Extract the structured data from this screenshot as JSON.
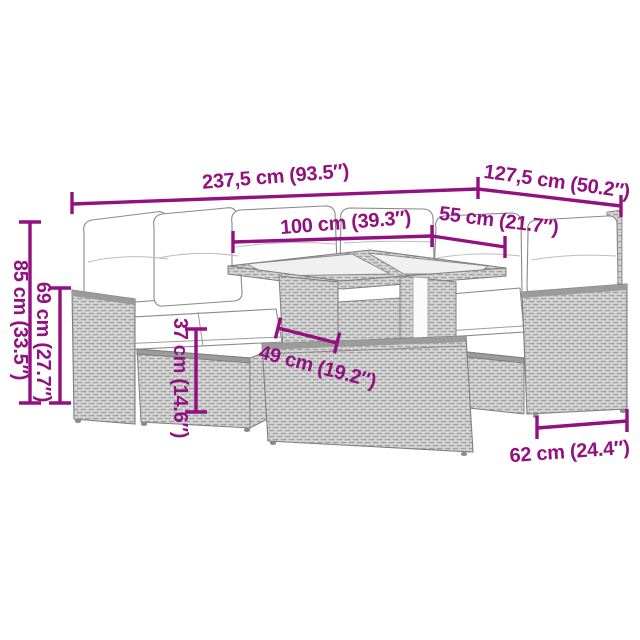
{
  "diagram_type": "product-dimension-diagram",
  "product": "rattan-garden-lounge-set-with-table-and-footstool",
  "colors": {
    "accent_magenta": "#92107f",
    "line_art_outline": "#7f7f7f",
    "rattan_light": "#d9d9d9",
    "rattan_weave": "#a3a3a3",
    "cushion_white": "#ffffff",
    "glass_gray": "#f0f0f0",
    "background": "#ffffff"
  },
  "dimensions": {
    "overall_length": {
      "label": "237,5 cm (93.5″)",
      "cm": "237,5",
      "inches": "93.5"
    },
    "overall_depth": {
      "label": "127,5 cm (50.2″)",
      "cm": "127,5",
      "inches": "50.2"
    },
    "table_length": {
      "label": "100 cm (39.3″)",
      "cm": "100",
      "inches": "39.3"
    },
    "table_width": {
      "label": "55 cm (21.7″)",
      "cm": "55",
      "inches": "21.7"
    },
    "total_height": {
      "label": "85 cm (33.5″)",
      "cm": "85",
      "inches": "33.5"
    },
    "back_height": {
      "label": "69 cm (27.7″)",
      "cm": "69",
      "inches": "27.7"
    },
    "seat_height": {
      "label": "37 cm (14.6″)",
      "cm": "37",
      "inches": "14.6"
    },
    "table_height": {
      "label": "49 cm (19.2″)",
      "cm": "49",
      "inches": "19.2"
    },
    "stool_width": {
      "label": "62 cm (24.4″)",
      "cm": "62",
      "inches": "24.4"
    }
  }
}
